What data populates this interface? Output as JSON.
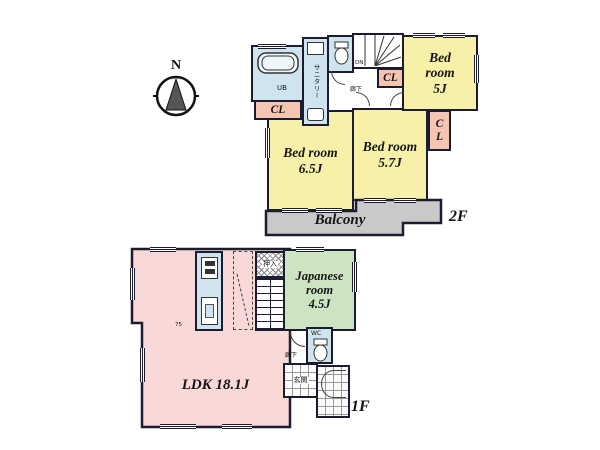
{
  "compass": {
    "label": "N"
  },
  "floor2": {
    "label": "2F",
    "bedroom5": {
      "name": "Bed room",
      "size": "5J"
    },
    "bedroom65": {
      "name": "Bed room",
      "size": "6.5J"
    },
    "bedroom57": {
      "name": "Bed room",
      "size": "5.7J"
    },
    "balcony": "Balcony",
    "closet_bath": "CL",
    "closet_hall": "CL",
    "closet_side": "CL",
    "bath": "UB",
    "sanitary": "サニタリー",
    "hallway": "廊下",
    "stairs": "DN"
  },
  "floor1": {
    "label": "1F",
    "ldk": "LDK 18.1J",
    "japanese": {
      "name": "Japanese room",
      "size": "4.5J"
    },
    "oshiire": "押入",
    "hallway": "廊下",
    "wc": "WC",
    "genkan": "玄関",
    "door_width": "75"
  },
  "colors": {
    "wall": "#1c1c30",
    "bedroom_yellow": "#f7f0a9",
    "closet_pink": "#f6c5b2",
    "water_blue": "#cfe4ee",
    "tatami_green": "#cde4c3",
    "ldk_pink": "#f9d8d8",
    "balcony_gray": "#c9c9c9"
  }
}
